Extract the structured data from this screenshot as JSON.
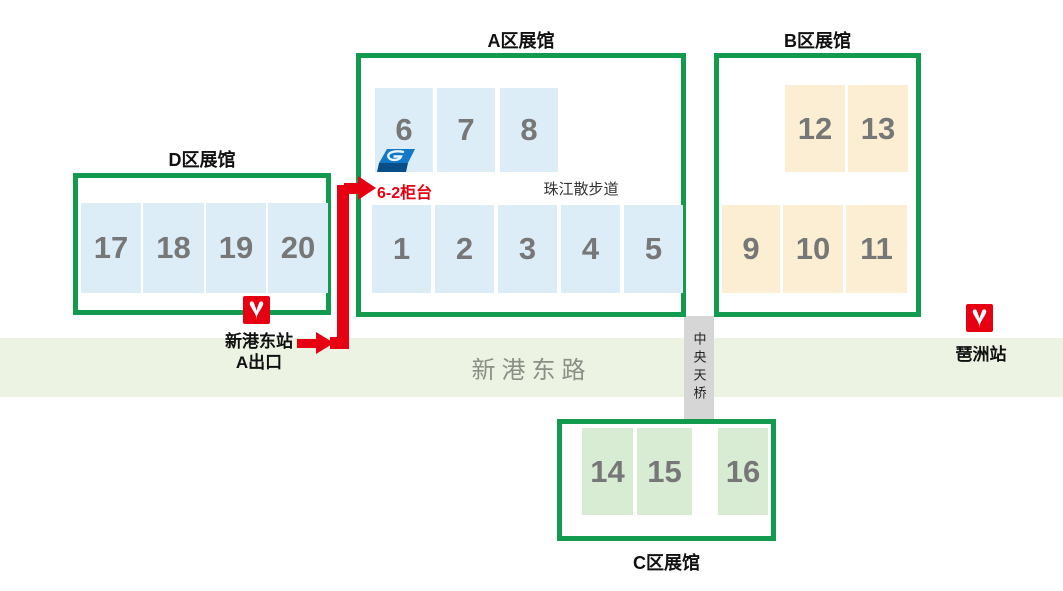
{
  "zones": {
    "A": {
      "title": "A区展馆",
      "top_row": [
        "6",
        "7",
        "8"
      ],
      "bottom_row": [
        "1",
        "2",
        "3",
        "4",
        "5"
      ],
      "promenade": "珠江散步道"
    },
    "B": {
      "title": "B区展馆",
      "top_row": [
        "12",
        "13"
      ],
      "bottom_row": [
        "9",
        "10",
        "11"
      ]
    },
    "C": {
      "title": "C区展馆",
      "row": [
        "14",
        "15",
        "16"
      ]
    },
    "D": {
      "title": "D区展馆",
      "row": [
        "17",
        "18",
        "19",
        "20"
      ]
    }
  },
  "road": {
    "label": "新港东路"
  },
  "bridge": {
    "label": "中央天桥"
  },
  "stations": {
    "xingangdong": {
      "name": "新港东站",
      "exit": "A出口"
    },
    "pazhou": {
      "name": "琶洲站"
    }
  },
  "route": {
    "counter_label": "6-2柜台"
  },
  "colors": {
    "zone_border": "#129b4f",
    "hall_blue": "#dcedf8",
    "hall_orange": "#fbeed3",
    "hall_green": "#d7ecd3",
    "road_bg": "#edf3e3",
    "bridge_bg": "#d6d6d6",
    "route_red": "#e60012",
    "number_gray": "#777777",
    "road_text": "#8b9086"
  }
}
